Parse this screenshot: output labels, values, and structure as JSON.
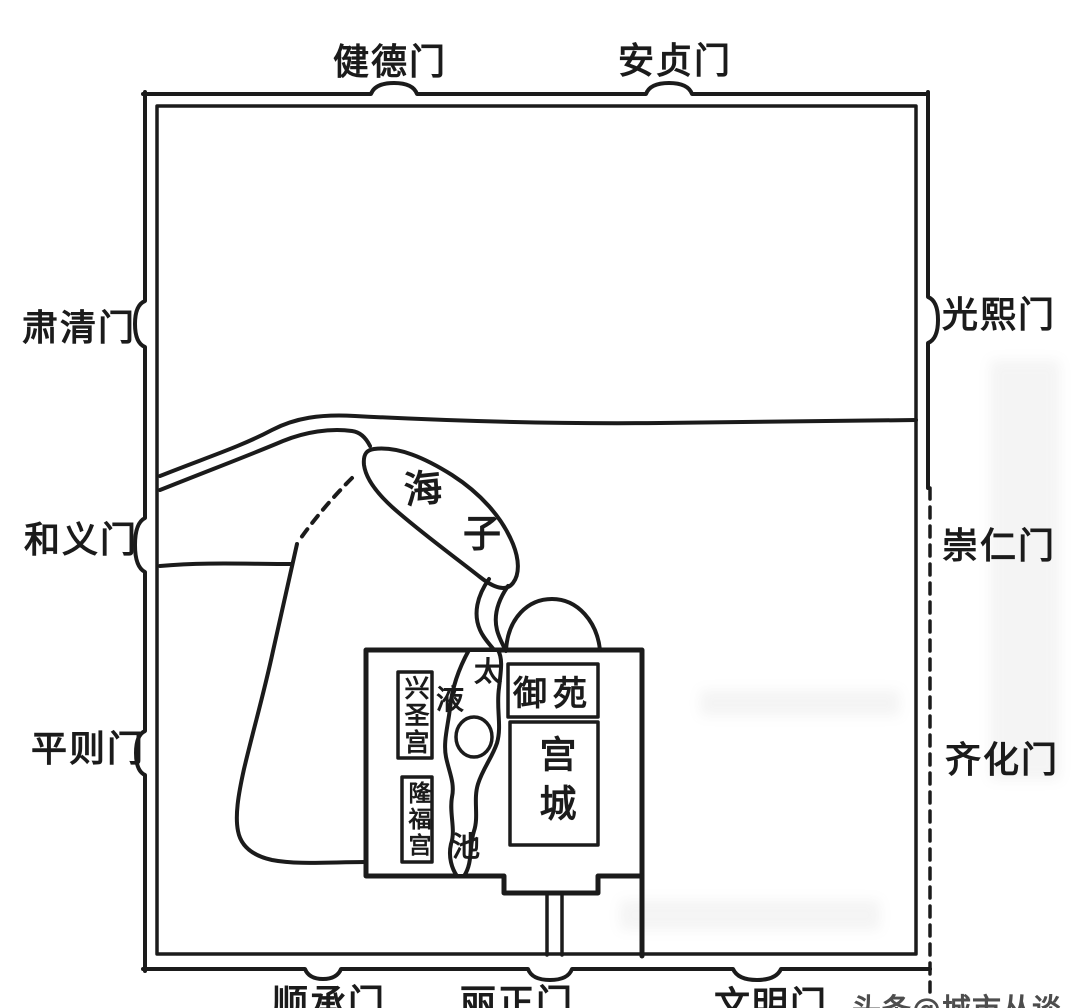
{
  "map": {
    "gates": {
      "top": [
        "健德门",
        "安贞门"
      ],
      "left": [
        "肃清门",
        "和义门",
        "平则门"
      ],
      "right": [
        "光熙门",
        "崇仁门",
        "齐化门"
      ],
      "bottom": [
        "顺承门",
        "丽正门",
        "文明门"
      ]
    },
    "water_labels": {
      "haizi_char1": "海",
      "haizi_char2": "子",
      "taiye_char1": "太",
      "taiye_char2": "液",
      "taiye_char3": "池"
    },
    "areas": {
      "xingshenggong": "兴圣宫",
      "longfugong": "隆福宫",
      "yuyuan": "御苑",
      "gongcheng": "宫城"
    },
    "watermark": "头条@城市丛谈",
    "colors": {
      "ink": "#1b1b1b",
      "paper": "#ffffff",
      "watermark_gray": "#4d4d4d"
    }
  }
}
